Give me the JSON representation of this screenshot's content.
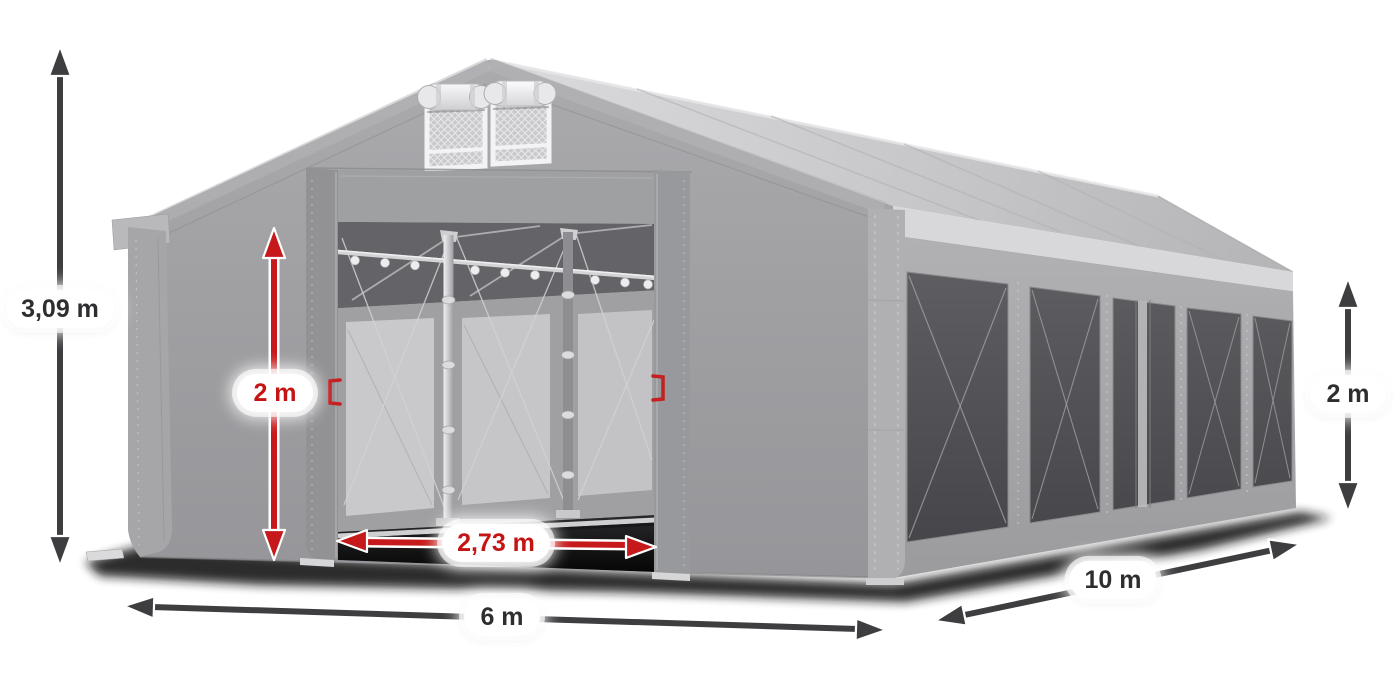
{
  "dimensions": {
    "total_height": "3,09 m",
    "entrance_height": "2 m",
    "entrance_width": "2,73 m",
    "front_width": "6 m",
    "side_length": "10 m",
    "side_wall_height": "2 m"
  },
  "colors": {
    "background": "#ffffff",
    "dimension_dark": "#2e2e30",
    "dimension_red": "#c41414",
    "arrow_dark": "#3e3e41",
    "arrow_red": "#c6191b",
    "tent_fabric": "#a1a1a4",
    "tent_roof": "#c9c9cb",
    "window_pane": "#55555a"
  }
}
